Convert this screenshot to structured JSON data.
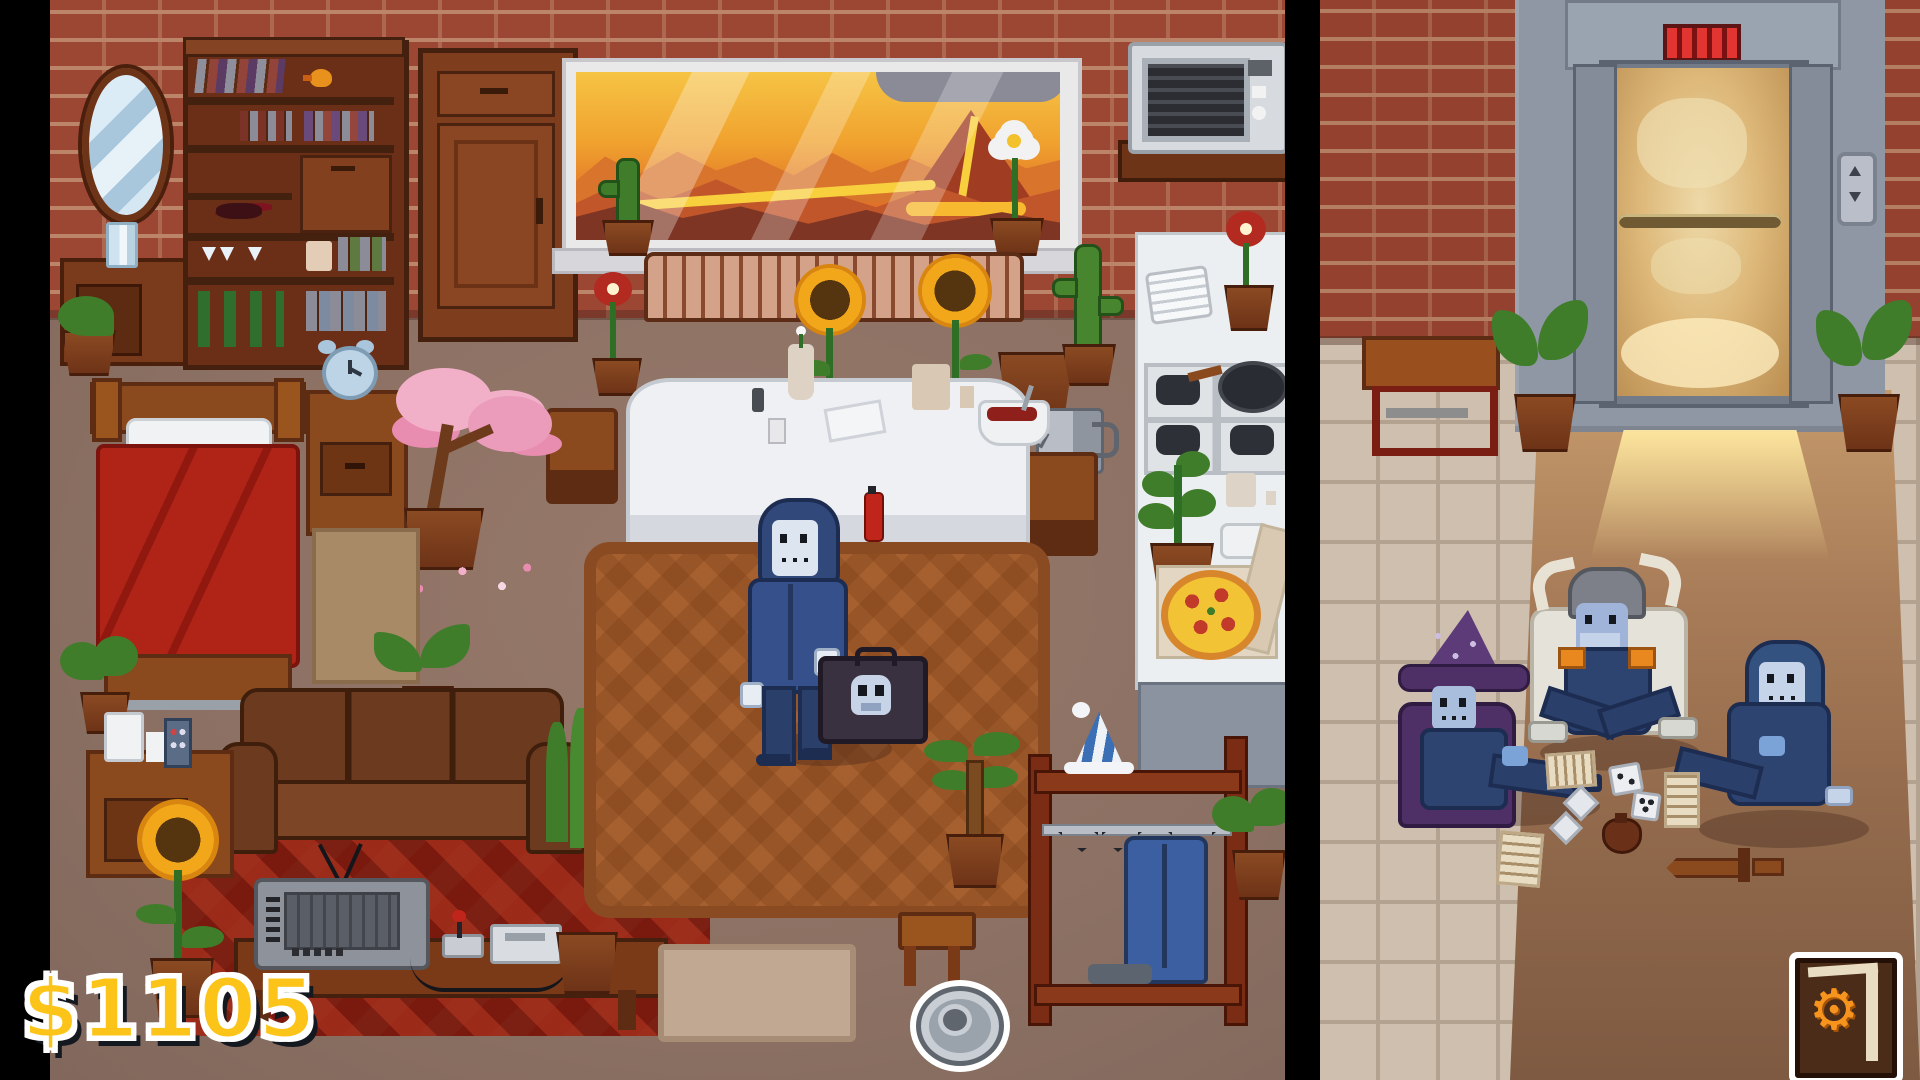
{
  "hud": {
    "money": "$1105",
    "money_color": "#fcc419",
    "settings_button": {
      "icon": "settings-book",
      "glyph": "⚙",
      "gear_color": "#f7941d"
    }
  },
  "colors": {
    "brick_wall": "#9c4634",
    "mortar": "#bc8468",
    "room_floor": "#8c7164",
    "hall_tile": "#cfbfae",
    "hall_carpet": "#9c7355",
    "elevator_frame": "#98a0ac",
    "elevator_light": "#f2d289",
    "center_rug": "#a6602f",
    "tv_rug": "#7d2014",
    "bed_blanket": "#b02418",
    "character_suit": "#31487a"
  }
}
